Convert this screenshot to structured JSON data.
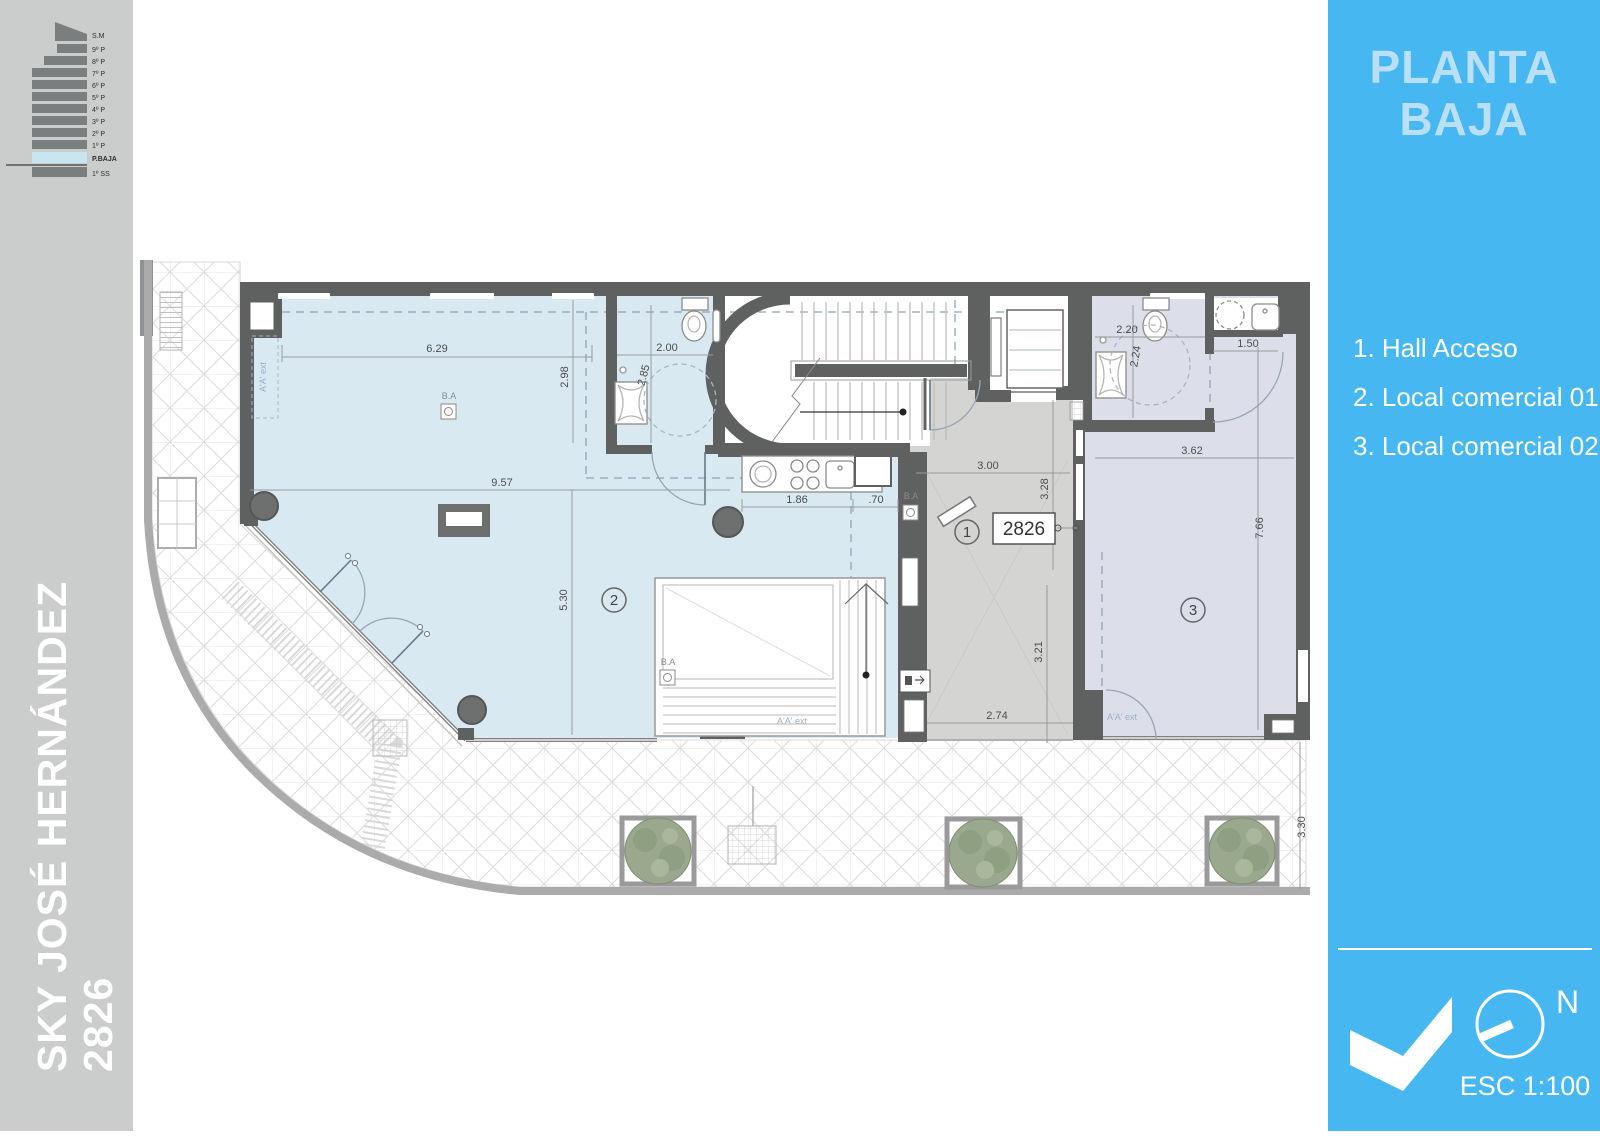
{
  "sidebar": {
    "project_line1": "SKY JOSÉ HERNÁNDEZ",
    "project_line2": "2826",
    "stack": {
      "floors": [
        "S.M",
        "9º P",
        "8º P",
        "7º P",
        "6º P",
        "5º P",
        "4º P",
        "3º P",
        "2º P",
        "1º P",
        "P.BAJA",
        "1º SS"
      ],
      "highlight": "P.BAJA"
    }
  },
  "panel": {
    "title_line1": "PLANTA",
    "title_line2": "BAJA",
    "legend": [
      "1. Hall Acceso",
      "2. Local comercial 01",
      "3. Local comercial 02"
    ],
    "north": "N",
    "scale": "ESC 1:100"
  },
  "plan": {
    "street_number": "2826",
    "markers": {
      "hall": "1",
      "local1": "2",
      "local2": "3"
    },
    "labels": {
      "ba": "B.A",
      "section": "A'A' ext"
    },
    "dims": {
      "d629": "6.29",
      "d298": "2.98",
      "d200": "2.00",
      "d285": "2.85",
      "d957": "9.57",
      "d186": "1.86",
      "d070": ".70",
      "d530": "5.30",
      "d300": "3.00",
      "d328": "3.28",
      "d220": "2.20",
      "d224": "2.24",
      "d150": "1.50",
      "d362": "3.62",
      "d766": "7.66",
      "d321": "3.21",
      "d274": "2.74",
      "d330": "3.30"
    }
  },
  "colors": {
    "panel_bg": "#47b7f2",
    "panel_title": "#b9e0f6",
    "sidebar_bg": "#cbcccc",
    "wall": "#5f6161",
    "local_comercial_floor": "#d9e9f2",
    "local_comercial2_floor": "#dcdfea",
    "hall_floor": "#d4d4d2",
    "stack_highlight": "#c9e5f2"
  }
}
